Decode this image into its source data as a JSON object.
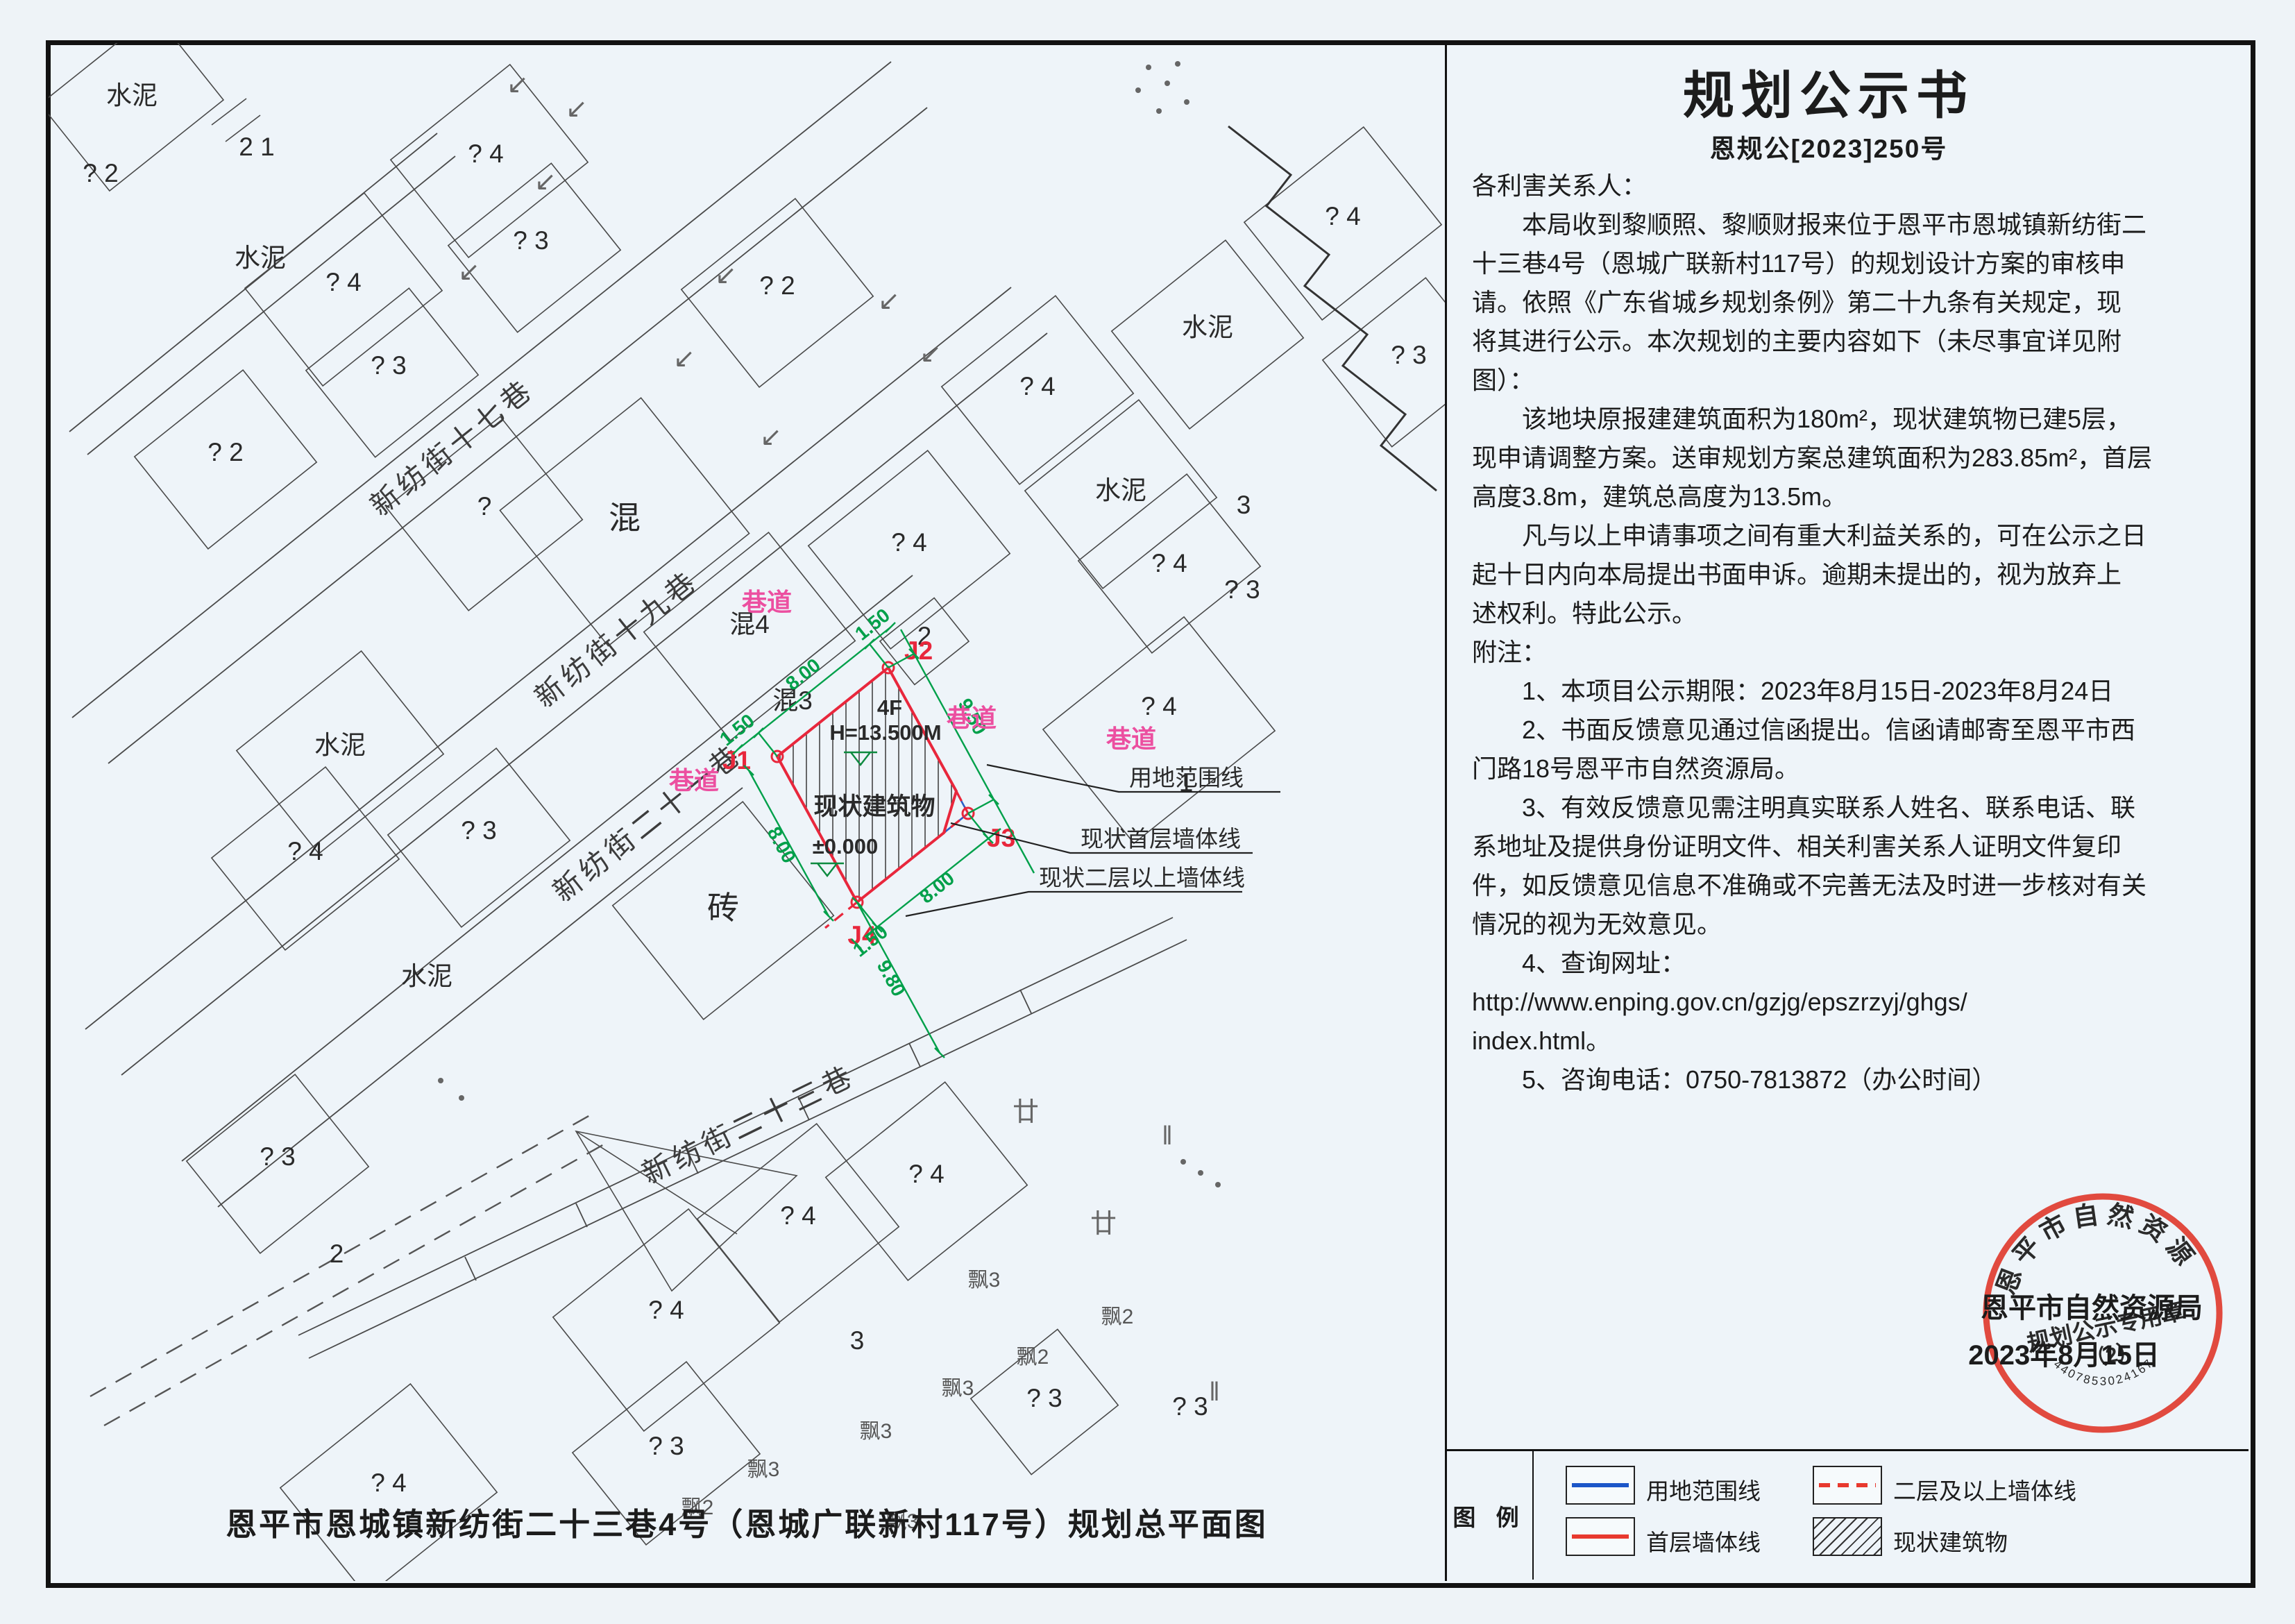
{
  "page": {
    "background": "#eef4f9",
    "ink": "#1c1c1c"
  },
  "notice": {
    "title": "规划公示书",
    "doc_no": "恩规公[2023]250号",
    "body": "各利害关系人：\n　　本局收到黎顺照、黎顺财报来位于恩平市恩城镇新纺街二\n十三巷4号（恩城广联新村117号）的规划设计方案的审核申\n请。依照《广东省城乡规划条例》第二十九条有关规定，现\n将其进行公示。本次规划的主要内容如下（未尽事宜详见附\n图）：\n　　该地块原报建建筑面积为180m²，现状建筑物已建5层，\n现申请调整方案。送审规划方案总建筑面积为283.85m²，首层\n高度3.8m，建筑总高度为13.5m。\n　　凡与以上申请事项之间有重大利益关系的，可在公示之日\n起十日内向本局提出书面申诉。逾期未提出的，视为放弃上\n述权利。特此公示。\n附注：\n　　1、本项目公示期限：2023年8月15日-2023年8月24日\n　　2、书面反馈意见通过信函提出。信函请邮寄至恩平市西\n门路18号恩平市自然资源局。\n　　3、有效反馈意见需注明真实联系人姓名、联系电话、联\n系地址及提供身份证明文件、相关利害关系人证明文件复印\n件，如反馈意见信息不准确或不完善无法及时进一步核对有关\n情况的视为无效意见。\n　　4、查询网址：\nhttp://www.enping.gov.cn/gzjg/epszrzyj/ghgs/\nindex.html。\n　　5、咨询电话：0750-7813872（办公时间）",
    "org": "恩平市自然资源局",
    "date": "2023年8月15日"
  },
  "seal": {
    "ring_text": "恩平市自然资源局",
    "center_text": "规划公示专用章",
    "sub_text": "（2）",
    "code": "4407853024167",
    "color": "#e03b2f"
  },
  "legend": {
    "title": "图 例",
    "items": [
      {
        "label": "用地范围线"
      },
      {
        "label": "二层及以上墙体线"
      },
      {
        "label": "首层墙体线"
      },
      {
        "label": "现状建筑物"
      }
    ]
  },
  "map": {
    "caption": "恩平市恩城镇新纺街二十三巷4号（恩城广联新村117号）规划总平面图",
    "streets": {
      "s17": "新纺街十七巷",
      "s19": "新纺街十九巷",
      "s21": "新纺街二十一巷",
      "s23": "新纺街二十三巷"
    },
    "lane": "巷道",
    "mat": {
      "cement": "水泥",
      "hun": "混",
      "hun4": "混4",
      "hun3": "混3",
      "brick": "砖"
    },
    "mk": {
      "q": "?",
      "q2": "? 2",
      "q3": "? 3",
      "q4": "? 4",
      "n1": "1",
      "n2": "2",
      "n3": "3",
      "n21": "2 1",
      "p2": "飘2",
      "p3": "飘3",
      "nian": "廿",
      "par": "‖",
      "arrow": "↙"
    },
    "site": {
      "floors": "4F",
      "height": "H=13.500M",
      "level": "±0.000",
      "building": "现状建筑物",
      "j1": "J1",
      "j2": "J2",
      "j3": "J3",
      "j4": "J4"
    },
    "dims": {
      "d8": "8.00",
      "d15": "1.50",
      "d95": "9.50",
      "d98": "9.80"
    },
    "callouts": {
      "boundary": "用地范围线",
      "first": "现状首层墙体线",
      "upper": "现状二层以上墙体线"
    },
    "colors": {
      "red": "#e8273c",
      "blue": "#2b5fc7",
      "green": "#00a04a",
      "pink": "#ec4fa0",
      "seal": "#e03b2f"
    }
  }
}
